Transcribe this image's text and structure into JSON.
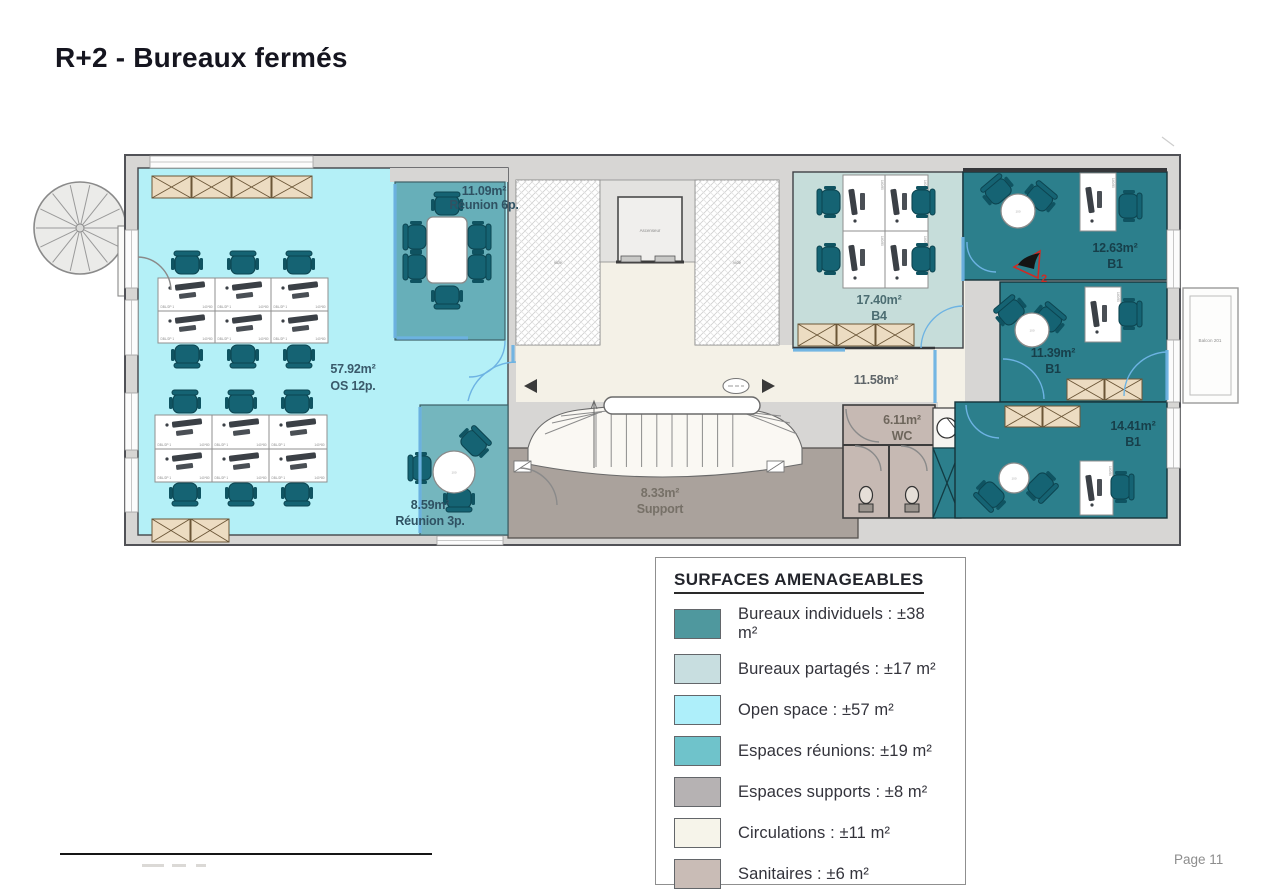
{
  "page": {
    "title": "R+2 - Bureaux fermés",
    "page_number": "Page 11"
  },
  "legend": {
    "title": "SURFACES AMENAGEABLES",
    "items": [
      {
        "key": "bureaux-individuels",
        "label": "Bureaux individuels : ±38 m²",
        "color": "#4f989e"
      },
      {
        "key": "bureaux-partages",
        "label": "Bureaux partagés : ±17 m²",
        "color": "#c8dee0"
      },
      {
        "key": "open-space",
        "label": "Open space : ±57 m²",
        "color": "#aeeffa"
      },
      {
        "key": "espaces-reunions",
        "label": "Espaces réunions: ±19 m²",
        "color": "#6fc3cb"
      },
      {
        "key": "espaces-supports",
        "label": "Espaces supports : ±8  m²",
        "color": "#b6b2b3"
      },
      {
        "key": "circulations",
        "label": "Circulations : ±11  m²",
        "color": "#f6f4ea"
      },
      {
        "key": "sanitaires",
        "label": "Sanitaires : ±6 m²",
        "color": "#c9bcb6"
      }
    ]
  },
  "rooms": {
    "open_space": {
      "area": "57.92m²",
      "name": "OS 12p."
    },
    "reunion6": {
      "area": "11.09m²",
      "name": "Réunion 6p."
    },
    "reunion3": {
      "area": "8.59m²",
      "name": "Réunion 3p."
    },
    "b4": {
      "area": "17.40m²",
      "name": "B4"
    },
    "b1_top": {
      "area": "12.63m²",
      "name": "B1"
    },
    "b1_mid": {
      "area": "11.39m²",
      "name": "B1"
    },
    "b1_bottom": {
      "area": "14.41m²",
      "name": "B1"
    },
    "support": {
      "area": "8.33m²",
      "name": "Support"
    },
    "wc": {
      "area": "6.11m²",
      "name": "WC"
    },
    "circulation": {
      "area": "11.58m²"
    },
    "balcony": {
      "name": "Balcon 201"
    }
  },
  "plan": {
    "elevator_label": "Ascenseur",
    "void_label": "vide",
    "photo_marker": "2",
    "table_label": "100",
    "desk_label": "DBL/2P 1",
    "desk_size_label": "140*80",
    "desk_size_vertical": "140/80"
  },
  "colors": {
    "wall": "#d7d6d4",
    "open_space": "#b4f0f7",
    "reunion": "#67afb9",
    "shared": "#c6ddda",
    "individual": "#2c7f8c",
    "support": "#aaa29c",
    "sanitary": "#c6b9b3",
    "circulation": "#f4f1e7",
    "glass": "#6db3e3",
    "radiator": "#ecdcc2"
  }
}
